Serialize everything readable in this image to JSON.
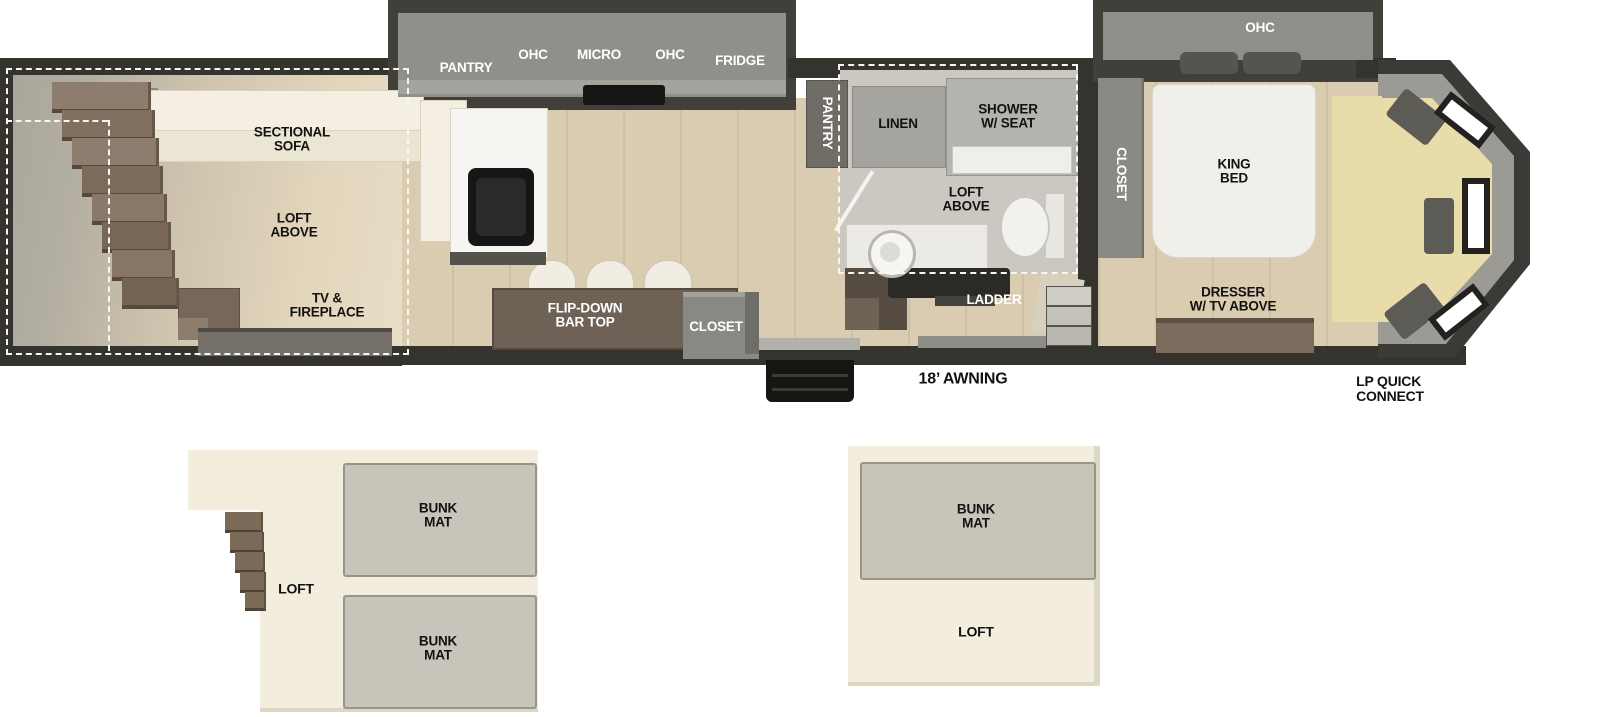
{
  "title": "RV travel trailer floorplan with loft",
  "colors": {
    "wall": "#35332e",
    "counter_gray": "#918f8a",
    "floor_tan": "#d9ccb1",
    "rear_floor_gray": "#aaa69c",
    "cream_furniture": "#f2edde",
    "bath_floor": "#cbc8c2",
    "bar_brown": "#6e6257",
    "desk_yellow": "#e9dcab",
    "loft_cream": "#f2eddc",
    "bunk_mat_gray": "#c7c4ba",
    "label_black": "#121212",
    "label_white": "#ffffff"
  },
  "floorplan": {
    "rear": {
      "sofa_label": "SECTIONAL\nSOFA",
      "loft_label": "LOFT\nABOVE",
      "tv_label": "TV &\nFIREPLACE"
    },
    "kitchen": {
      "pantry_label": "PANTRY",
      "ohc_left_label": "OHC",
      "micro_label": "MICRO",
      "ohc_right_label": "OHC",
      "fridge_label": "FRIDGE",
      "bar_label": "FLIP-DOWN\nBAR TOP",
      "closet_label": "CLOSET"
    },
    "bath": {
      "pantry_label": "PANTRY",
      "linen_label": "LINEN",
      "shower_label": "SHOWER\nW/ SEAT",
      "loft_label": "LOFT\nABOVE",
      "ladder_label": "LADDER"
    },
    "bedroom": {
      "ohc_label": "OHC",
      "closet_label": "CLOSET",
      "bed_label": "KING\nBED",
      "dresser_label": "DRESSER\nW/ TV ABOVE"
    },
    "exterior": {
      "awning_label": "18’ AWNING",
      "lp_label": "LP QUICK\nCONNECT"
    }
  },
  "loft_diagrams": {
    "left": {
      "loft_label": "LOFT",
      "bunk_top_label": "BUNK\nMAT",
      "bunk_bottom_label": "BUNK\nMAT"
    },
    "right": {
      "bunk_label": "BUNK\nMAT",
      "loft_label": "LOFT"
    }
  }
}
